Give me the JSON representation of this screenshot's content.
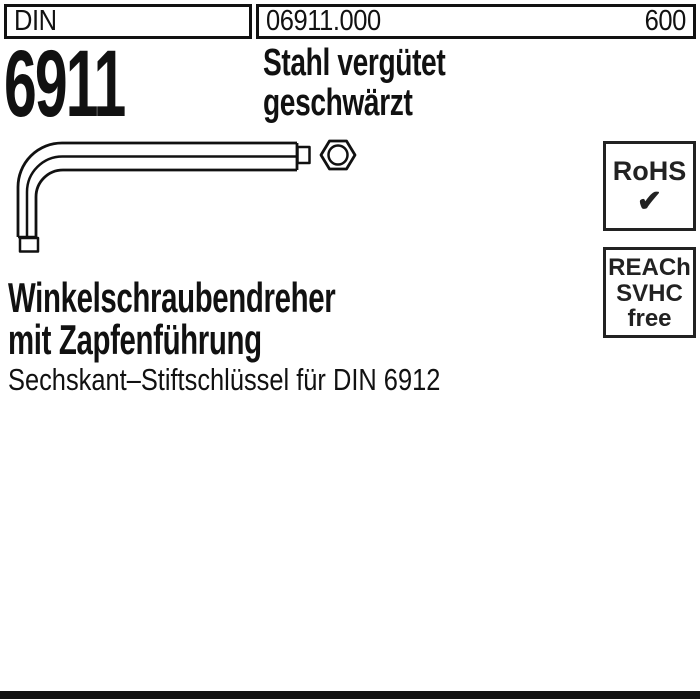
{
  "header": {
    "standard_label": "DIN",
    "article_number": "06911.000",
    "page_number": "600"
  },
  "product": {
    "din_number": "6911",
    "material_line1": "Stahl vergütet",
    "material_line2": "geschwärzt",
    "title_line1": "Winkelschraubendreher",
    "title_line2": "mit Zapfenführung",
    "subtitle": "Sechskant–Stiftschlüssel für DIN 6912"
  },
  "badges": {
    "rohs": {
      "label": "RoHS",
      "checkmark": "✔"
    },
    "reach": {
      "line1": "REACh",
      "line2": "SVHC",
      "line3": "free"
    }
  },
  "drawing": {
    "description": "L-shaped hex key (Allen key) side view with pilot tip and hexagonal cross-section end view"
  },
  "colors": {
    "ink": "#111111",
    "badge_ink": "#222222",
    "bar": "#111111"
  }
}
